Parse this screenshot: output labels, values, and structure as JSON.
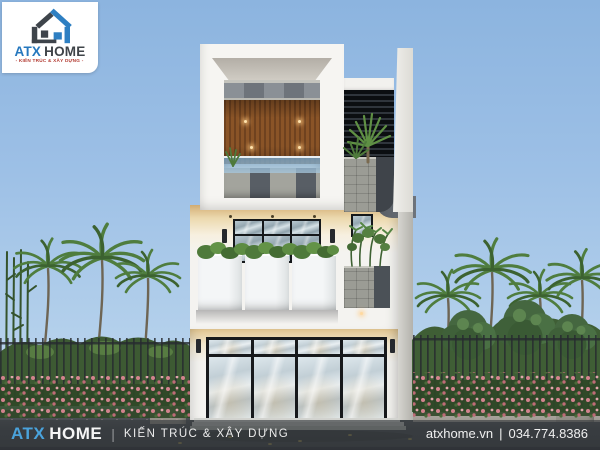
{
  "logo": {
    "icon": "atx-home-logo-icon",
    "brand_primary": "ATX",
    "brand_secondary": "HOME",
    "tagline": "- KIẾN TRÚC & XÂY DỰNG -",
    "primary_color": "#2678be",
    "secondary_color": "#3f4449",
    "tagline_color": "#b23a31"
  },
  "footer": {
    "brand_primary": "ATX",
    "brand_secondary": "HOME",
    "divider": "|",
    "tagline": "KIẾN TRÚC & XÂY DỰNG",
    "website": "atxhome.vn",
    "separator": "|",
    "phone": "034.774.8386",
    "brand_primary_color": "#4aa3dc",
    "bar_color": "rgba(56,60,64,0.66)"
  },
  "scene": {
    "subject": "three-story modern townhouse architectural rendering",
    "sky_top_color": "#8cb4df",
    "sky_bottom_color": "#c6dcf0",
    "wood_accent_color": "#7b4b24",
    "foliage_color": "#4a7a3c",
    "flower_color": "#d2838d",
    "stone_color": "#9b9c95"
  }
}
